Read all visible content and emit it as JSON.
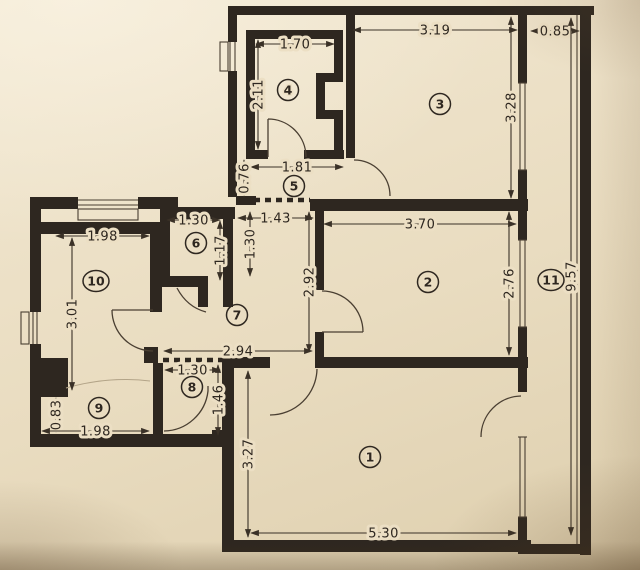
{
  "document": {
    "kind": "apartment floor plan scan"
  },
  "colors": {
    "paper": "#ecdfc4",
    "ink": "#2e2720",
    "dimline": "#3a3127"
  },
  "rooms": [
    {
      "number": "1",
      "x": 370,
      "y": 457
    },
    {
      "number": "2",
      "x": 428,
      "y": 282
    },
    {
      "number": "3",
      "x": 440,
      "y": 104
    },
    {
      "number": "4",
      "x": 288,
      "y": 90
    },
    {
      "number": "5",
      "x": 294,
      "y": 186
    },
    {
      "number": "6",
      "x": 196,
      "y": 243
    },
    {
      "number": "7",
      "x": 237,
      "y": 315
    },
    {
      "number": "8",
      "x": 192,
      "y": 387
    },
    {
      "number": "9",
      "x": 99,
      "y": 408
    },
    {
      "number": "10",
      "x": 96,
      "y": 281
    },
    {
      "number": "11",
      "x": 551,
      "y": 280
    }
  ],
  "dimensions": [
    {
      "text": "1.70",
      "orient": "h",
      "y": 44,
      "x1": 256,
      "x2": 334
    },
    {
      "text": "2.11",
      "orient": "v",
      "x": 258,
      "y1": 40,
      "y2": 149
    },
    {
      "text": "3.19",
      "orient": "h",
      "y": 30,
      "x1": 353,
      "x2": 517
    },
    {
      "text": "0.85",
      "orient": "h",
      "y": 31,
      "x1": 531,
      "x2": 579
    },
    {
      "text": "3.28",
      "orient": "v",
      "x": 511,
      "y1": 17,
      "y2": 198
    },
    {
      "text": "1.81",
      "orient": "h",
      "y": 167,
      "x1": 251,
      "x2": 343
    },
    {
      "text": "0.76",
      "orient": "v",
      "x": 244,
      "y1": 160,
      "y2": 197
    },
    {
      "text": "1.43",
      "orient": "h",
      "y": 218,
      "x1": 238,
      "x2": 313
    },
    {
      "text": "1.30",
      "orient": "v",
      "x": 250,
      "y1": 212,
      "y2": 276
    },
    {
      "text": "2.92",
      "orient": "v",
      "x": 309,
      "y1": 212,
      "y2": 352
    },
    {
      "text": "3.70",
      "orient": "h",
      "y": 224,
      "x1": 324,
      "x2": 516
    },
    {
      "text": "2.76",
      "orient": "v",
      "x": 509,
      "y1": 212,
      "y2": 355
    },
    {
      "text": "9.57",
      "orient": "v",
      "x": 571,
      "y1": 18,
      "y2": 535
    },
    {
      "text": "1.30",
      "orient": "h",
      "y": 220,
      "x1": 167,
      "x2": 220
    },
    {
      "text": "1.17",
      "orient": "v",
      "x": 220,
      "y1": 221,
      "y2": 280
    },
    {
      "text": "1.98",
      "orient": "h",
      "y": 236,
      "x1": 56,
      "x2": 149
    },
    {
      "text": "3.01",
      "orient": "v",
      "x": 72,
      "y1": 238,
      "y2": 390
    },
    {
      "text": "0.83",
      "orient": "v",
      "x": 56,
      "y1": 398,
      "y2": 432
    },
    {
      "text": "1.98",
      "orient": "h",
      "y": 431,
      "x1": 42,
      "x2": 149
    },
    {
      "text": "2.94",
      "orient": "h",
      "y": 351,
      "x1": 164,
      "x2": 312
    },
    {
      "text": "1.30",
      "orient": "h",
      "y": 370,
      "x1": 165,
      "x2": 220
    },
    {
      "text": "1.46",
      "orient": "v",
      "x": 218,
      "y1": 365,
      "y2": 435
    },
    {
      "text": "3.27",
      "orient": "v",
      "x": 248,
      "y1": 371,
      "y2": 537
    },
    {
      "text": "5.30",
      "orient": "h",
      "y": 533,
      "x1": 251,
      "x2": 516
    }
  ]
}
